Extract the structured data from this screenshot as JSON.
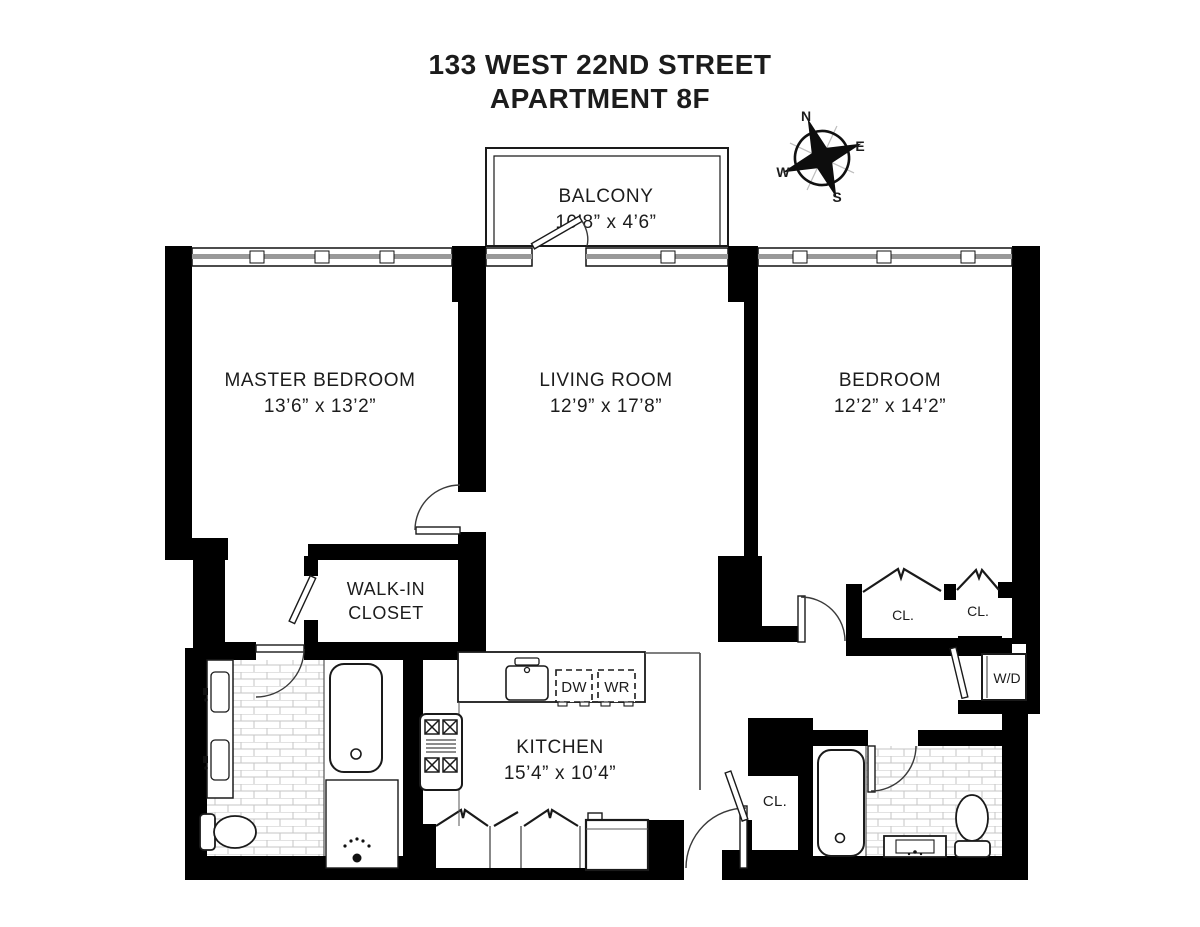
{
  "title": {
    "line1": "133 WEST 22ND STREET",
    "line2": "APARTMENT 8F"
  },
  "compass": {
    "n": "N",
    "e": "E",
    "s": "S",
    "w": "W"
  },
  "rooms": {
    "balcony": {
      "name": "BALCONY",
      "dims": "10’8” x 4’6”"
    },
    "master_bedroom": {
      "name": "MASTER BEDROOM",
      "dims": "13’6” x 13’2”"
    },
    "living_room": {
      "name": "LIVING ROOM",
      "dims": "12’9” x 17’8”"
    },
    "bedroom": {
      "name": "BEDROOM",
      "dims": "12’2” x 14’2”"
    },
    "walk_in_closet": {
      "line1": "WALK-IN",
      "line2": "CLOSET"
    },
    "kitchen": {
      "name": "KITCHEN",
      "dims": "15’4” x 10’4”"
    }
  },
  "labels": {
    "closet_bedroom_left": "CL.",
    "closet_bedroom_right": "CL.",
    "closet_hall": "CL.",
    "washer_dryer": "W/D",
    "dishwasher": "DW",
    "washer": "WR"
  },
  "icons": [
    "compass-rose-icon",
    "bathtub-icon",
    "toilet-icon",
    "double-sink-icon",
    "stove-icon",
    "kitchen-sink-icon",
    "refrigerator-icon",
    "shower-icon",
    "washer-dryer-icon",
    "door-swing-icon",
    "bifold-door-icon",
    "window-icon"
  ],
  "colors": {
    "walls": "#000000",
    "background": "#ffffff",
    "window_line": "#999999",
    "tile_line": "#c6c6c6"
  }
}
